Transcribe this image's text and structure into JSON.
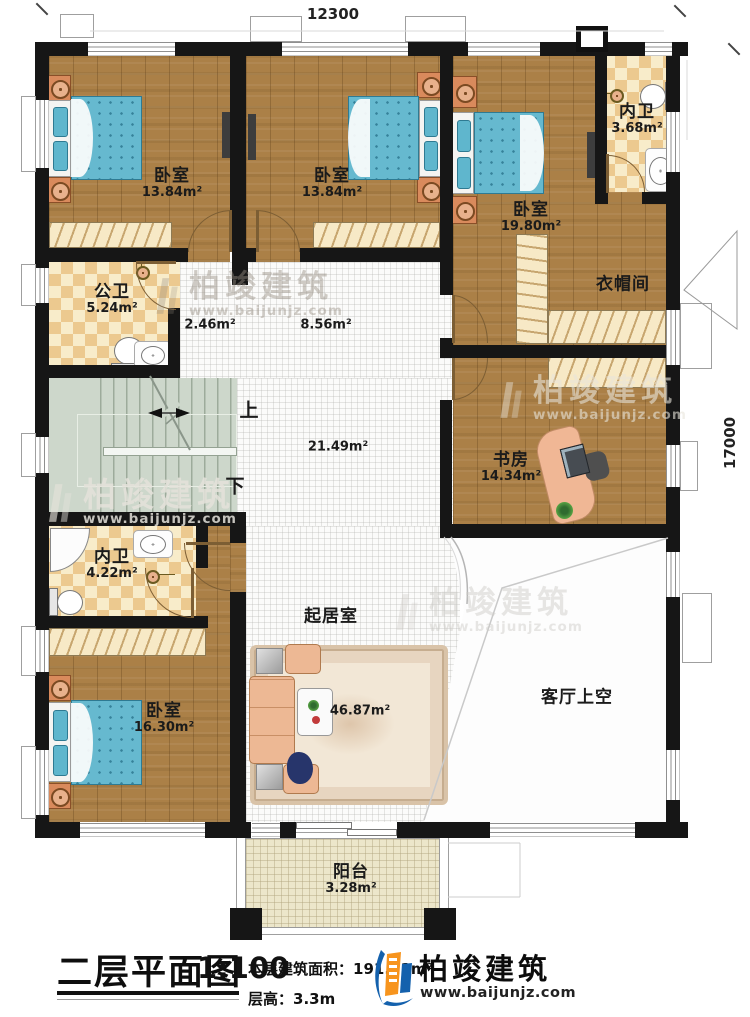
{
  "dimensions": {
    "width": "12300",
    "height": "17000"
  },
  "rooms": [
    {
      "name": "卧室",
      "area": "13.84m²"
    },
    {
      "name": "卧室",
      "area": "13.84m²"
    },
    {
      "name": "卧室",
      "area": "19.80m²"
    },
    {
      "name": "内卫",
      "area": "3.68m²"
    },
    {
      "name": "公卫",
      "area": "5.24m²"
    },
    {
      "name": "",
      "area": "2.46m²"
    },
    {
      "name": "",
      "area": "8.56m²"
    },
    {
      "name": "",
      "area": "21.49m²"
    },
    {
      "name": "衣帽间",
      "area": ""
    },
    {
      "name": "书房",
      "area": "14.34m²"
    },
    {
      "name": "内卫",
      "area": "4.22m²"
    },
    {
      "name": "卧室",
      "area": "16.30m²"
    },
    {
      "name": "起居室",
      "area": "46.87m²"
    },
    {
      "name": "客厅上空",
      "area": ""
    },
    {
      "name": "阳台",
      "area": "3.28m²"
    }
  ],
  "stairs": {
    "up": "上",
    "down": "下"
  },
  "title_block": {
    "title": "二层平面图",
    "scale": "1:100",
    "area_label": "本层建筑面积：",
    "area_value": "191.11m²",
    "height_label": "层高：",
    "height_value": "3.3m"
  },
  "brand": {
    "name": "柏竣建筑",
    "url": "www.baijunjz.com"
  },
  "watermark": {
    "name": "柏竣建筑",
    "url": "www.baijunjz.com"
  }
}
